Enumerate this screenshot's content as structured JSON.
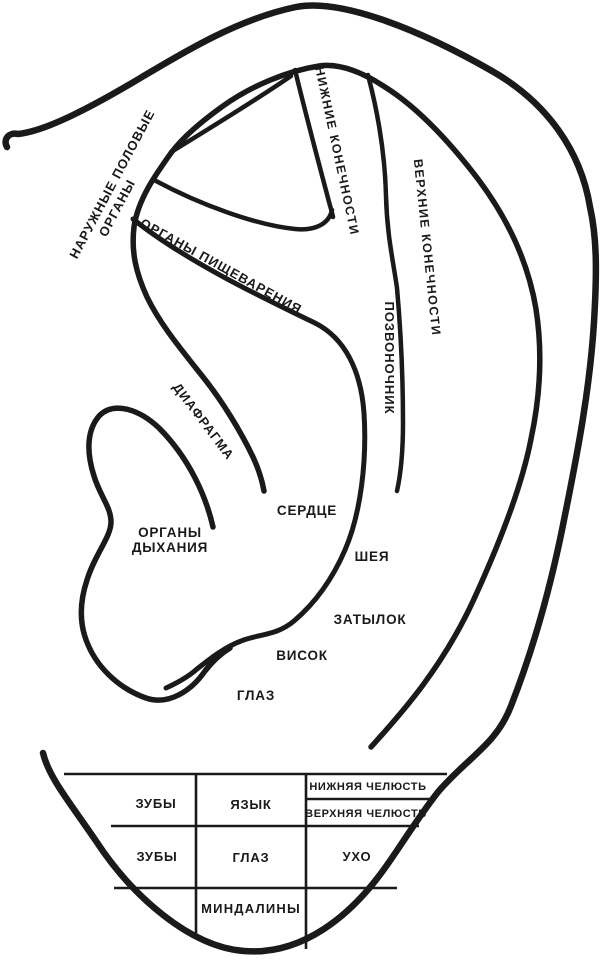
{
  "colors": {
    "ink": "#1a1a1a",
    "background": "#ffffff"
  },
  "zones": {
    "external_genitals_1": "НАРУЖНЫЕ ПОЛОВЫЕ",
    "external_genitals_2": "ОРГАНЫ",
    "digestive_organs": "ОРГАНЫ ПИЩЕВАРЕНИЯ",
    "lower_limbs": "НИЖНИЕ КОНЕЧНОСТИ",
    "upper_limbs": "ВЕРХНИЕ КОНЕЧНОСТИ",
    "spine": "ПОЗВОНОЧНИК",
    "diaphragm": "ДИАФРАГМА",
    "heart": "СЕРДЦЕ",
    "respiratory_1": "ОРГАНЫ",
    "respiratory_2": "ДЫХАНИЯ",
    "neck": "ШЕЯ",
    "occiput": "ЗАТЫЛОК",
    "temple": "ВИСОК",
    "eye": "ГЛАЗ"
  },
  "lobe_table": {
    "teeth_row1": "ЗУБЫ",
    "tongue": "ЯЗЫК",
    "lower_jaw": "НИЖНЯЯ ЧЕЛЮСТЬ",
    "upper_jaw": "ВЕРХНЯЯ ЧЕЛЮСТЬ",
    "teeth_row2": "ЗУБЫ",
    "eye": "ГЛАЗ",
    "ear": "УХО",
    "tonsils": "МИНДАЛИНЫ"
  }
}
